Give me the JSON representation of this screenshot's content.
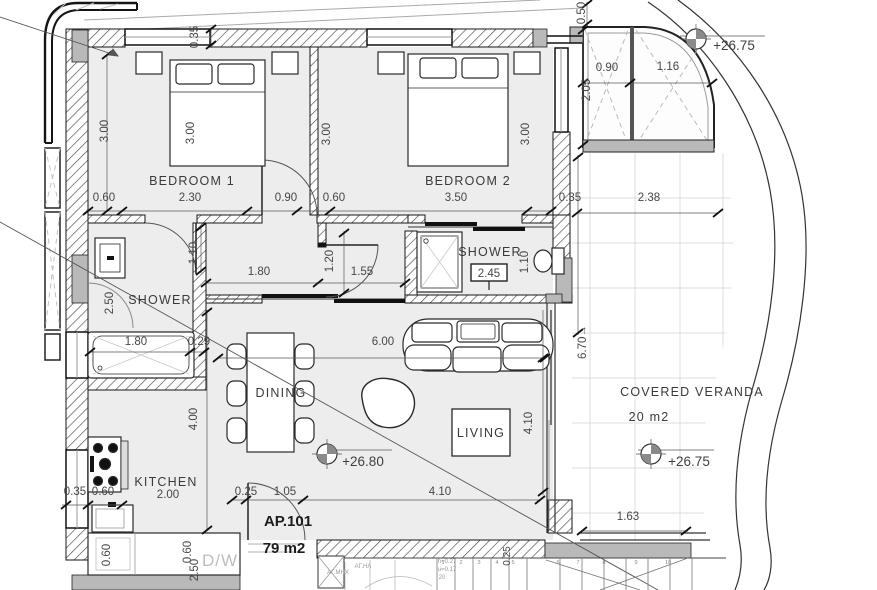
{
  "plan": {
    "apartment": {
      "id": "AP.101",
      "area": "79 m2"
    },
    "rooms": {
      "bedroom1": {
        "label": "BEDROOM 1",
        "width": "2.30",
        "depth": "3.00",
        "bed": "3.00",
        "offset": "0.60",
        "door": "0.90",
        "wall": "0.35"
      },
      "bedroom2": {
        "label": "BEDROOM 2",
        "width": "3.50",
        "depth": "3.00",
        "bed": "3.00",
        "offset": "0.60",
        "wall": "0.35"
      },
      "shower1": {
        "label": "SHOWER",
        "depth": "2.50",
        "door": "1.10",
        "tub": "1.80",
        "ledge": "0.29"
      },
      "shower2": {
        "label": "SHOWER",
        "clear_height": "2.45",
        "fixture": "1.10"
      },
      "hall": {
        "seg1": "1.80",
        "seg2": "1.55",
        "width": "1.20"
      },
      "dining": {
        "label": "DINING"
      },
      "living": {
        "label": "LIVING",
        "width": "6.00",
        "depth": "4.10",
        "level": "+26.80"
      },
      "kitchen": {
        "label": "KITCHEN",
        "width": "2.00",
        "depth": "4.00",
        "a": "0.35",
        "b": "0.60",
        "c": "0.60",
        "d": "0.60",
        "e": "2.50",
        "dw": "D/W"
      },
      "entry": {
        "a": "0.25",
        "b": "1.05",
        "c": "4.10"
      },
      "veranda": {
        "label": "COVERED VERANDA",
        "area": "20 m2",
        "level": "+26.75",
        "width": "2.38",
        "length": "6.70→",
        "south": "1.63"
      },
      "glazed": {
        "a": "0.90",
        "b": "1.16",
        "h": "2.05",
        "top": "0.50",
        "level": "+26.75"
      }
    },
    "stairs": {
      "steps": [
        "1",
        "2",
        "3",
        "4",
        "5",
        "6",
        "7",
        "8",
        "9",
        "10"
      ],
      "note_h": "h=0.27",
      "note_u": "u=0.17",
      "note_n": "20",
      "riser": "0.25",
      "shaft1": "ΑΓ.ΜΗΧ",
      "shaft2": "ΑΓ.ΗΛ"
    }
  }
}
